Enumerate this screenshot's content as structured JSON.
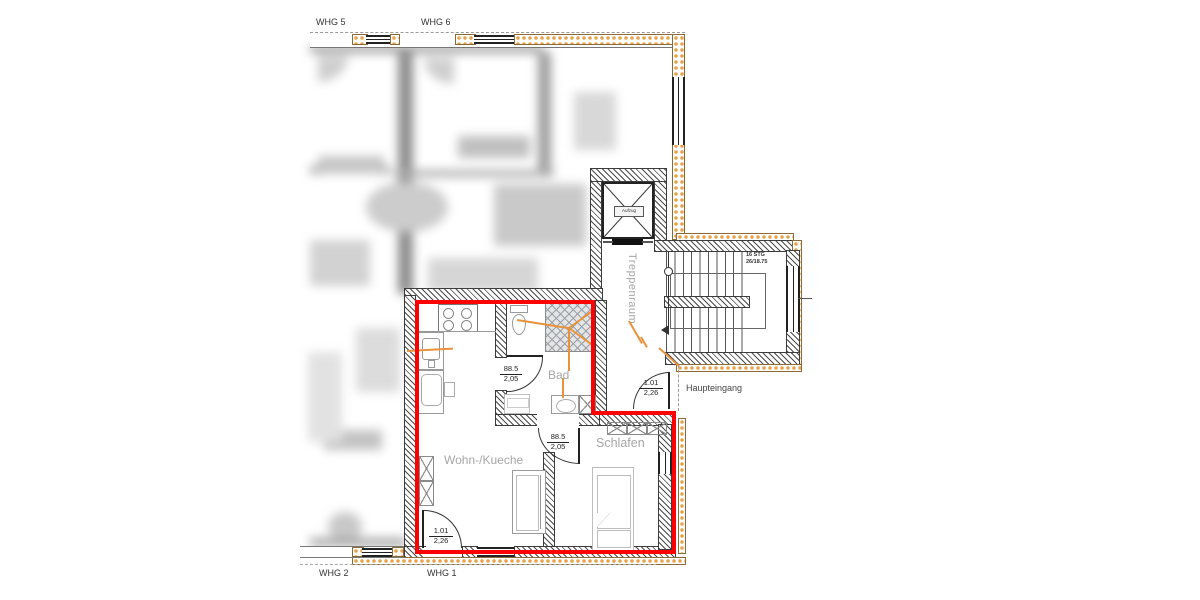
{
  "plan": {
    "units": [
      {
        "id": "whg5",
        "label": "WHG 5"
      },
      {
        "id": "whg6",
        "label": "WHG 6"
      },
      {
        "id": "whg2",
        "label": "WHG 2"
      },
      {
        "id": "whg1",
        "label": "WHG 1"
      }
    ],
    "rooms": [
      {
        "id": "wohn_kueche",
        "label": "Wohn-/Kueche"
      },
      {
        "id": "schlafen",
        "label": "Schlafen"
      },
      {
        "id": "bad",
        "label": "Bad"
      },
      {
        "id": "treppenraum",
        "label": "Treppenraum"
      }
    ],
    "labels": {
      "haupteingang": "Haupteingang",
      "aufzug": "Aufzug"
    },
    "stair_note": {
      "line1": "16 STG",
      "line2": "26/18.75"
    },
    "dimensions": {
      "bad_door": {
        "num": "88.5",
        "den": "2,05"
      },
      "schlafen_door": {
        "num": "88.5",
        "den": "2,05"
      },
      "haupteingang_door": {
        "num": "1.01",
        "den": "2,26"
      },
      "balcony_door": {
        "num": "1.01",
        "den": "2,26"
      }
    },
    "colors": {
      "highlight_red": "#fe0000",
      "insulation_orange": "#e9a24b",
      "utility_orange": "#e8923c",
      "room_label_gray": "#a6a6a6"
    }
  }
}
